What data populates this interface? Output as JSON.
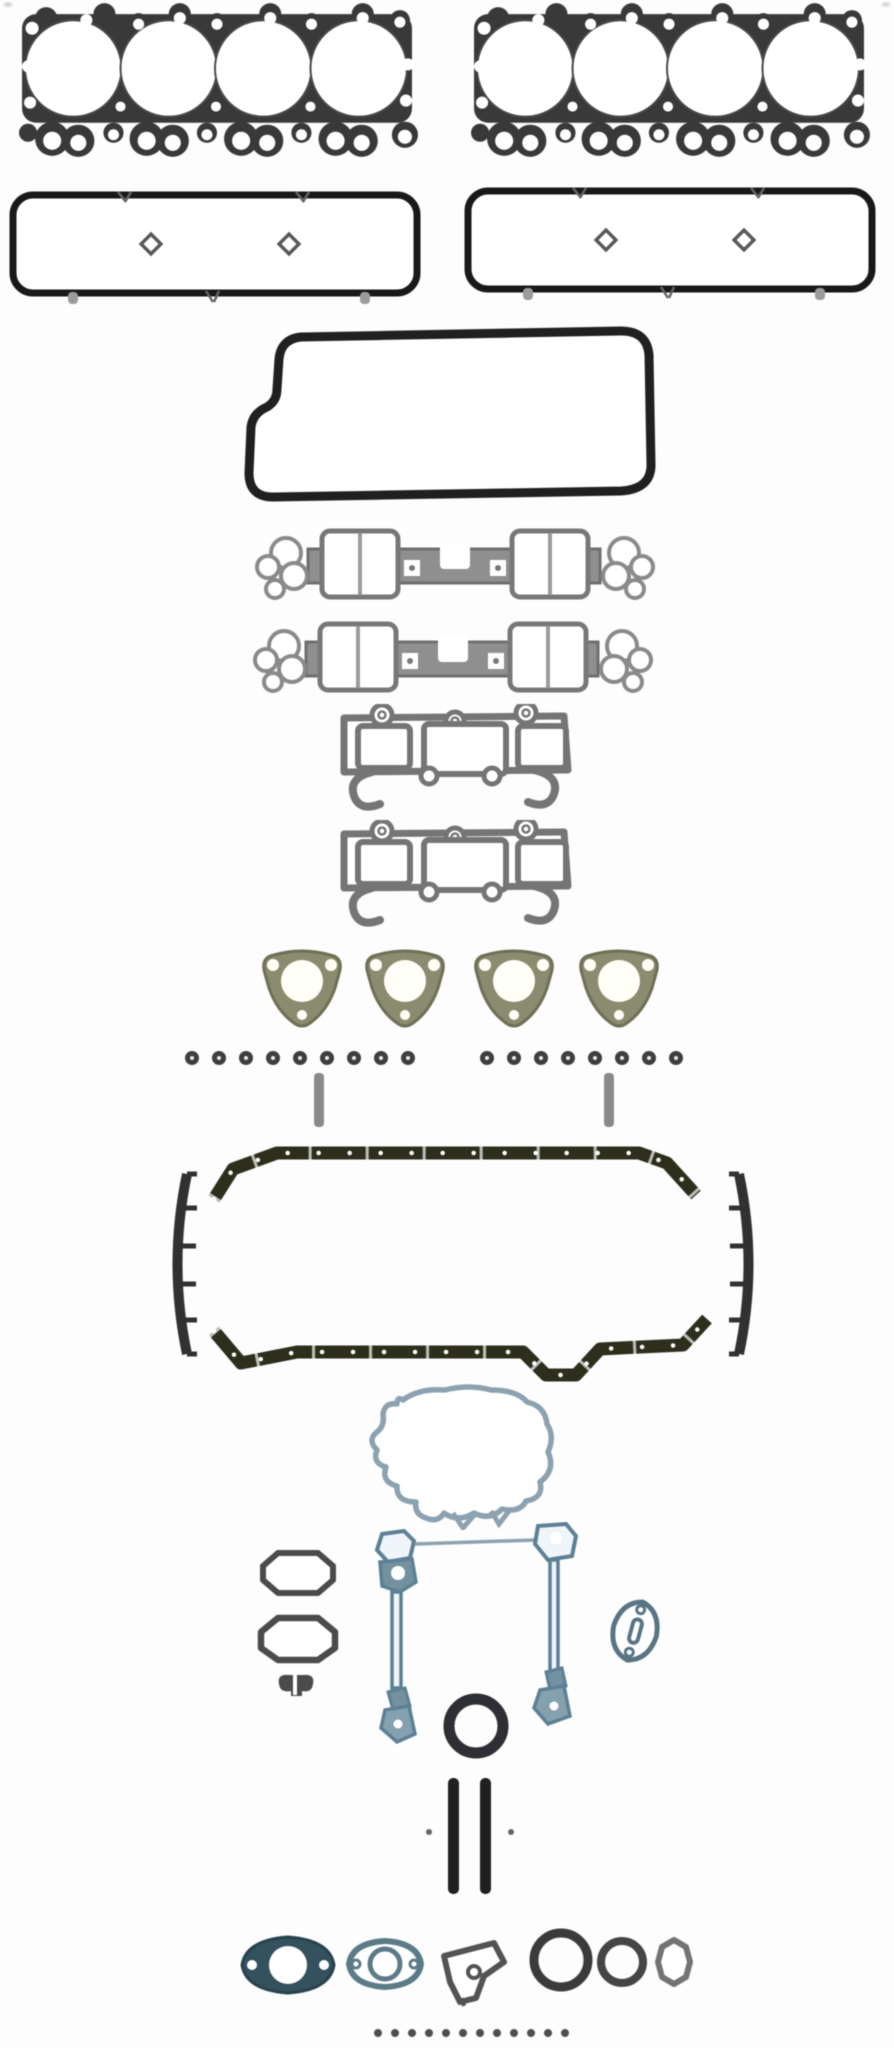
{
  "scene": {
    "type": "product-photo",
    "description": "Grayscale product photo of a complete automotive engine overhaul gasket set laid out on a white background",
    "background": "#fdfdfd"
  },
  "palette": {
    "head_gasket_dark": "#3a3a3a",
    "ring_outline_black": "#1b1b1b",
    "plate_outline": "#222222",
    "intake_gray": "#8f8f8f",
    "exhaust_gray": "#757575",
    "flange_olive": "#8b8b70",
    "pan_rail_olive": "#30301f",
    "pan_end_dark": "#333333",
    "timing_steel_blue": "#8ca1af",
    "seal_strip_blue": "#5d8095",
    "pipe_flange_teal": "#35525f",
    "crank_seal_black": "#303036",
    "grommet_gray": "#4f4f4f"
  },
  "counts": {
    "head_gaskets": 2,
    "valve_cover_gaskets": 2,
    "intake_manifold_gaskets": 2,
    "exhaust_manifold_gaskets": 2,
    "triangular_flange_gaskets": 4,
    "seal_row_left": 10,
    "seal_row_right": 9,
    "seal_row_bottom": 12
  },
  "items": [
    {
      "id": "head-gasket-left",
      "label": "Four-bore cylinder head gasket, left",
      "color": "#3a3a3a"
    },
    {
      "id": "head-gasket-right",
      "label": "Four-bore cylinder head gasket, right",
      "color": "#3a3a3a"
    },
    {
      "id": "valve-cover-gasket-left",
      "label": "Rectangular valve cover gasket ring, left",
      "color": "#1b1b1b"
    },
    {
      "id": "valve-cover-gasket-right",
      "label": "Rectangular valve cover gasket ring, right",
      "color": "#1b1b1b"
    },
    {
      "id": "cover-plate-gasket",
      "label": "Large notched cover plate gasket ring",
      "color": "#222222"
    },
    {
      "id": "intake-manifold-gasket-upper",
      "label": "Intake manifold gasket, upper",
      "color": "#8f8f8f"
    },
    {
      "id": "intake-manifold-gasket-lower",
      "label": "Intake manifold gasket, lower",
      "color": "#8f8f8f"
    },
    {
      "id": "exhaust-manifold-gasket-upper",
      "label": "Three-port exhaust manifold gasket, upper",
      "color": "#757575"
    },
    {
      "id": "exhaust-manifold-gasket-lower",
      "label": "Three-port exhaust manifold gasket, lower",
      "color": "#757575"
    },
    {
      "id": "exhaust-flange-gasket-1",
      "label": "Triangular exhaust flange gasket 1",
      "color": "#8b8b70"
    },
    {
      "id": "exhaust-flange-gasket-2",
      "label": "Triangular exhaust flange gasket 2",
      "color": "#8b8b70"
    },
    {
      "id": "exhaust-flange-gasket-3",
      "label": "Triangular exhaust flange gasket 3",
      "color": "#8b8b70"
    },
    {
      "id": "exhaust-flange-gasket-4",
      "label": "Triangular exhaust flange gasket 4",
      "color": "#8b8b70"
    },
    {
      "id": "seal-row-left",
      "label": "Row of ten small valve seals",
      "color": "#3f3f3f"
    },
    {
      "id": "seal-row-right",
      "label": "Row of nine small valve seals",
      "color": "#3f3f3f"
    },
    {
      "id": "dowel-left",
      "label": "Small gray dowel strip, left",
      "color": "#8a8a8a"
    },
    {
      "id": "dowel-right",
      "label": "Small gray dowel strip, right",
      "color": "#8a8a8a"
    },
    {
      "id": "oil-pan-rail-top",
      "label": "Oil pan gasket rail, top",
      "color": "#30301f"
    },
    {
      "id": "oil-pan-side-seal-left",
      "label": "Oil pan curved end seal, left",
      "color": "#333333"
    },
    {
      "id": "oil-pan-side-seal-right",
      "label": "Oil pan curved end seal, right",
      "color": "#333333"
    },
    {
      "id": "oil-pan-rail-bottom",
      "label": "Oil pan gasket rail with dip, bottom",
      "color": "#30301f"
    },
    {
      "id": "front-cover-gasket",
      "label": "Irregular front timing cover gasket outline",
      "color": "#8ca1af"
    },
    {
      "id": "outlet-gasket-upper",
      "label": "Octagonal water outlet gasket, upper",
      "color": "#4c4c4c"
    },
    {
      "id": "outlet-gasket-lower",
      "label": "Octagonal water outlet gasket, lower",
      "color": "#4c4c4c"
    },
    {
      "id": "small-twin-grommet",
      "label": "Small twin-lobe grommet",
      "color": "#4c4c4c"
    },
    {
      "id": "seal-strip-left",
      "label": "Blue seal strip assembly, left",
      "color": "#5d8095"
    },
    {
      "id": "connector-strip",
      "label": "Thin connector strip",
      "color": "#8ca1af"
    },
    {
      "id": "seal-strip-right",
      "label": "Blue seal strip assembly, right",
      "color": "#5d8095"
    },
    {
      "id": "pump-mount-oval-gasket",
      "label": "Small slotted oval pump gasket",
      "color": "#5a7585"
    },
    {
      "id": "round-seal",
      "label": "Round crankshaft seal",
      "color": "#303036"
    },
    {
      "id": "dowel-pin-pair",
      "label": "Pair of black dowel pins",
      "color": "#1f1f1f"
    },
    {
      "id": "flange-gasket-solid",
      "label": "Solid teal exhaust pipe flange gasket",
      "color": "#35525f"
    },
    {
      "id": "flange-gasket-outline",
      "label": "Outlined exhaust pipe flange gasket",
      "color": "#5d7b88"
    },
    {
      "id": "bracket-gasket",
      "label": "Angular bracket gasket with hole",
      "color": "#545454"
    },
    {
      "id": "o-ring-large",
      "label": "Large O-ring seal",
      "color": "#3c3c3c"
    },
    {
      "id": "o-ring-medium",
      "label": "Medium O-ring seal",
      "color": "#464646"
    },
    {
      "id": "o-ring-octagonal",
      "label": "Small octagonal ring seal",
      "color": "#737373"
    },
    {
      "id": "seal-row-bottom",
      "label": "Row of twelve small seals",
      "color": "#4f4f4f"
    }
  ]
}
